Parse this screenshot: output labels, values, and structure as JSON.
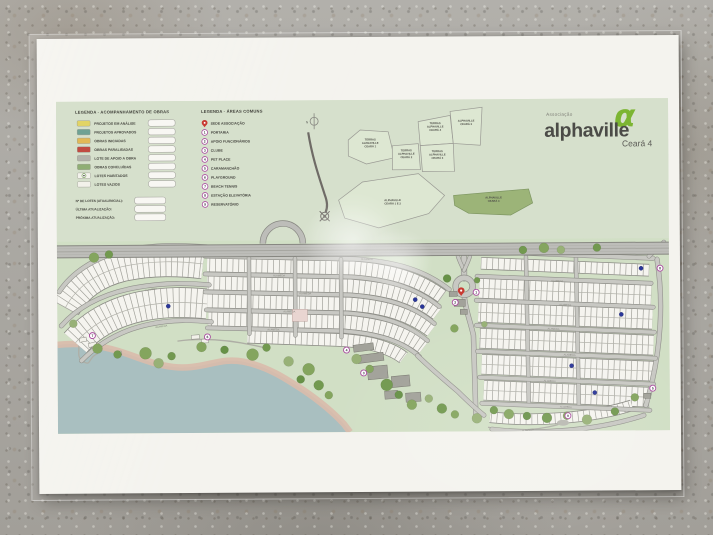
{
  "brand": {
    "association": "Associação",
    "name": "alphaville",
    "phase": "Ceará 4",
    "logo_glyph": "α",
    "logo_green": "#7cb532"
  },
  "legend_obras": {
    "title": "LEGENDA - ACOMPANHAMENTO DE OBRAS",
    "items": [
      {
        "label": "PROJETOS EM ANÁLISE",
        "color": "#e2d465",
        "type": "swatch"
      },
      {
        "label": "PROJETOS APROVADOS",
        "color": "#6fa294",
        "type": "swatch"
      },
      {
        "label": "OBRAS INICIADAS",
        "color": "#e2b957",
        "type": "swatch"
      },
      {
        "label": "OBRAS PARALISADAS",
        "color": "#c14b42",
        "type": "swatch"
      },
      {
        "label": "LOTE DE APOIO A OBRA",
        "color": "#b3b3ab",
        "type": "swatch"
      },
      {
        "label": "OBRAS CONCLUÍDAS",
        "color": "#8fae74",
        "type": "swatch"
      },
      {
        "label": "LOTES HABITADOS",
        "color": "#f3f2ec",
        "type": "dot"
      },
      {
        "label": "LOTES VAZIOS",
        "color": "#f2f1ea",
        "type": "swatch"
      }
    ],
    "fields": [
      "Nº DE LOTES (ATUAL/INICIAL):",
      "ÚLTIMA ATUALIZAÇÃO:",
      "PRÓXIMA ATUALIZAÇÃO:"
    ]
  },
  "legend_areas": {
    "title": "LEGENDA - ÁREAS COMUNS",
    "items": [
      {
        "marker": "pin",
        "label": "SEDE ASSOCIAÇÃO"
      },
      {
        "marker": "1",
        "label": "PORTARIA"
      },
      {
        "marker": "2",
        "label": "APOIO FUNCIONÁRIOS"
      },
      {
        "marker": "3",
        "label": "CLUBE"
      },
      {
        "marker": "4",
        "label": "PET PLACE"
      },
      {
        "marker": "5",
        "label": "CARAMANCHÃO"
      },
      {
        "marker": "6",
        "label": "PLAYGROUND"
      },
      {
        "marker": "7",
        "label": "BEACH TENNIS"
      },
      {
        "marker": "8",
        "label": "ESTAÇÃO ELEVATÓRIA"
      },
      {
        "marker": "9",
        "label": "RESERVATÓRIO"
      }
    ]
  },
  "inset": {
    "north_label": "N",
    "areas": [
      {
        "lines": [
          "TERRAS",
          "ALPHAVILLE",
          "CEARÁ 1"
        ],
        "points": "292,40 304,30 332,32 338,58 310,64 292,56",
        "cx": 314,
        "cy": 44,
        "highlight": false
      },
      {
        "lines": [
          "TERRAS",
          "ALPHAVILLE",
          "CEARÁ 2"
        ],
        "points": "336,46 362,44 364,70 336,70",
        "cx": 350,
        "cy": 55,
        "highlight": false
      },
      {
        "lines": [
          "TERRAS",
          "ALPHAVILLE",
          "CEARÁ 4"
        ],
        "points": "362,22 394,16 397,44 364,46",
        "cx": 379,
        "cy": 28,
        "highlight": false
      },
      {
        "lines": [
          "ALPHAVILLE",
          "CEARÁ 3"
        ],
        "points": "394,12 426,8 424,46 397,44",
        "cx": 410,
        "cy": 24,
        "highlight": false
      },
      {
        "lines": [
          "TERRAS",
          "ALPHAVILLE",
          "CEARÁ 3"
        ],
        "points": "364,46 397,44 398,72 366,72",
        "cx": 381,
        "cy": 56,
        "highlight": false
      },
      {
        "lines": [
          "ALPHAVILLE",
          "CEARÁ 4"
        ],
        "points": "397,96 472,90 476,104 454,116 412,114 398,106",
        "cx": 437,
        "cy": 101,
        "highlight": true
      },
      {
        "lines": [
          "ALPHAVILLE",
          "CEARÁ 1 E 2"
        ],
        "points": "282,100 306,82 362,74 388,96 372,114 322,128 288,118",
        "cx": 336,
        "cy": 103,
        "highlight": false
      }
    ]
  },
  "map": {
    "street_label": "ALAMEDA",
    "colors": {
      "lot_fill": "#f5f4ef",
      "lot_edge": "#8b8b85",
      "lot_div": "#a2a29b",
      "street": "#c8c8c3",
      "street_edge": "#90908a",
      "highway": "#bdbdb9",
      "highway_edge": "#878781",
      "water": "#a9bfc0",
      "beach": "#d9bcab",
      "marker_ring": "#a84a9e",
      "pin_red": "#c83a32",
      "dot_blue": "#2a3699",
      "paralisada": "#e9d5d1"
    },
    "lake_shore": "M 0 243 C 28 240, 52 246, 74 254 C 98 263, 114 268, 134 266 C 154 264, 166 257, 186 261 C 210 266, 228 278, 246 290 C 262 301, 276 313, 286 324 L 292 332",
    "strips": [
      {
        "d": "M 8 206 C 18 188, 36 172, 66 165 C 96 159, 122 160, 146 163",
        "w": 29,
        "double": true
      },
      {
        "d": "M 18 241 C 32 225, 54 211, 84 205 C 110 200, 130 201, 150 203",
        "w": 29,
        "double": true
      },
      {
        "d": "M 150 164 L 296 168 C 336 171, 362 180, 385 197",
        "w": 13,
        "double": false
      },
      {
        "d": "M 150 182 L 294 186 C 332 189, 358 197, 380 214",
        "w": 13,
        "double": false
      },
      {
        "d": "M 150 200 L 292 204 C 329 207, 353 215, 374 231",
        "w": 13,
        "double": false
      },
      {
        "d": "M 151 218 L 288 222 C 324 225, 347 233, 366 248",
        "w": 13,
        "double": false
      },
      {
        "d": "M 190 236 L 286 240 C 314 242, 333 248, 346 258",
        "w": 12,
        "double": false
      },
      {
        "d": "M 424 164 L 592 172",
        "w": 11,
        "double": false
      },
      {
        "d": "M 422 189 L 594 197",
        "w": 19,
        "double": true
      },
      {
        "d": "M 421 213 L 595 221",
        "w": 19,
        "double": true
      },
      {
        "d": "M 422 239 L 596 247",
        "w": 19,
        "double": true
      },
      {
        "d": "M 424 265 L 596 273",
        "w": 19,
        "double": true
      },
      {
        "d": "M 426 291 L 592 299",
        "w": 19,
        "double": true
      },
      {
        "d": "M 432 318 C 476 323, 532 320, 574 307",
        "w": 10,
        "double": false
      }
    ],
    "streets": [
      {
        "d": "M 2 190 C 14 172, 36 156, 68 149 C 98 143, 124 144, 150 146",
        "w": 3.8
      },
      {
        "d": "M 4 224 C 20 206, 44 192, 80 186 C 110 181, 132 182, 152 184",
        "w": 3.8
      },
      {
        "d": "M 24 259 C 40 243, 62 229, 92 223 C 116 218, 136 219, 154 221",
        "w": 3.8
      },
      {
        "d": "M 148 155 L 298 159 C 340 162, 368 171, 392 190",
        "w": 3.8
      },
      {
        "d": "M 148 173 L 295 177 C 334 180, 360 189, 382 207",
        "w": 3.5
      },
      {
        "d": "M 148 191 L 293 195 C 330 198, 356 206, 377 224",
        "w": 3.5
      },
      {
        "d": "M 149 209 L 290 213 C 326 216, 350 224, 370 241",
        "w": 3.5
      },
      {
        "d": "M 150 227 L 287 231 C 321 234, 344 241, 362 257",
        "w": 3.5
      },
      {
        "d": "M 192 157 L 192 233",
        "w": 3.2
      },
      {
        "d": "M 238 158 L 238 235",
        "w": 3.2
      },
      {
        "d": "M 284 159 L 284 237",
        "w": 3.2
      },
      {
        "d": "M 407 158 L 407 179",
        "w": 5
      },
      {
        "d": "M 407 196 C 408 210, 413 222, 416 236 L 418 318",
        "w": 4.2
      },
      {
        "d": "M 469 158 L 471 306",
        "w": 3.2
      },
      {
        "d": "M 519 159 L 521 308",
        "w": 3.2
      },
      {
        "d": "M 600 161 C 606 200, 605 252, 588 307",
        "w": 4
      },
      {
        "d": "M 420 152 L 596 160",
        "w": 3.8
      },
      {
        "d": "M 420 177 L 594 185",
        "w": 3.5
      },
      {
        "d": "M 419 201 L 596 209",
        "w": 3.5
      },
      {
        "d": "M 419 226 L 597 234",
        "w": 3.5
      },
      {
        "d": "M 420 252 L 598 260",
        "w": 3.5
      },
      {
        "d": "M 422 278 L 596 286",
        "w": 3.5
      },
      {
        "d": "M 424 304 L 592 312",
        "w": 3.5
      },
      {
        "d": "M 434 330 C 480 336, 540 332, 586 317",
        "w": 3.8
      },
      {
        "d": "M 360 256 C 372 268, 386 280, 400 292 C 408 300, 416 308, 426 316",
        "w": 3.8
      },
      {
        "d": "M 401 157 C 403 163, 405 167, 407 171",
        "w": 3
      },
      {
        "d": "M 413 157 C 411 163, 409 167, 407 171",
        "w": 3
      },
      {
        "d": "M 592 158 C 599 151, 603 148, 607 144",
        "w": 3.5
      }
    ],
    "trails": [
      "M 18 234 C 26 246, 16 254, 26 260 C 34 265, 30 256, 40 252",
      "M 120 240 C 150 236, 180 240, 210 248",
      "M 430 328 C 460 334, 488 330, 506 324 C 530 316, 520 318, 545 315 C 560 313, 572 310, 584 305"
    ],
    "highway": {
      "y": 150,
      "half": 6,
      "loop_cx": 226,
      "loop_r": 20,
      "roundabout": {
        "x": 407,
        "y": 187,
        "r": 8.5
      }
    },
    "trees": [
      [
        37,
        156,
        5,
        0
      ],
      [
        52,
        153,
        4,
        1
      ],
      [
        16,
        222,
        4,
        2
      ],
      [
        40,
        247,
        5,
        0
      ],
      [
        60,
        253,
        4,
        1
      ],
      [
        88,
        252,
        6,
        0
      ],
      [
        101,
        262,
        5,
        2
      ],
      [
        114,
        255,
        4,
        1
      ],
      [
        144,
        246,
        5,
        0
      ],
      [
        167,
        249,
        4,
        3
      ],
      [
        195,
        254,
        6,
        0
      ],
      [
        209,
        247,
        4,
        1
      ],
      [
        231,
        261,
        5,
        2
      ],
      [
        251,
        269,
        6,
        0
      ],
      [
        243,
        279,
        4,
        3
      ],
      [
        261,
        285,
        5,
        1
      ],
      [
        271,
        295,
        4,
        0
      ],
      [
        299,
        259,
        5,
        2
      ],
      [
        312,
        269,
        4,
        0
      ],
      [
        329,
        285,
        6,
        1
      ],
      [
        341,
        295,
        4,
        3
      ],
      [
        354,
        305,
        5,
        0
      ],
      [
        371,
        299,
        4,
        2
      ],
      [
        384,
        309,
        5,
        1
      ],
      [
        397,
        315,
        4,
        0
      ],
      [
        419,
        319,
        5,
        2
      ],
      [
        436,
        311,
        4,
        1
      ],
      [
        451,
        315,
        5,
        0
      ],
      [
        469,
        317,
        4,
        3
      ],
      [
        489,
        319,
        5,
        1
      ],
      [
        509,
        317,
        4,
        0
      ],
      [
        529,
        321,
        5,
        2
      ],
      [
        557,
        313,
        4,
        1
      ],
      [
        577,
        299,
        4,
        0
      ],
      [
        390,
        179,
        4,
        3
      ],
      [
        420,
        181,
        3,
        1
      ],
      [
        397,
        229,
        4,
        0
      ],
      [
        427,
        225,
        3,
        2
      ],
      [
        466,
        151,
        4,
        1
      ],
      [
        487,
        149,
        5,
        0
      ],
      [
        504,
        151,
        4,
        2
      ],
      [
        540,
        149,
        4,
        1
      ]
    ],
    "tree_colors": [
      "#84a55e",
      "#72994f",
      "#98b177",
      "#679147"
    ],
    "buildings": [
      [
        296,
        244,
        20,
        7,
        -7,
        "g"
      ],
      [
        300,
        254,
        26,
        8,
        -7,
        "g"
      ],
      [
        310,
        266,
        20,
        13,
        -5,
        "g"
      ],
      [
        334,
        276,
        18,
        11,
        -5,
        "g"
      ],
      [
        327,
        291,
        13,
        8,
        -4,
        "g"
      ],
      [
        348,
        293,
        15,
        9,
        -4,
        "g"
      ],
      [
        392,
        192,
        8,
        5,
        0,
        "g"
      ],
      [
        397,
        200,
        11,
        7,
        0,
        "g"
      ],
      [
        403,
        210,
        7,
        5,
        0,
        "g"
      ],
      [
        22,
        236,
        7,
        4,
        -10,
        "w"
      ],
      [
        31,
        241,
        8,
        4,
        -14,
        "w"
      ],
      [
        134,
        234,
        8,
        4,
        -4,
        "w"
      ],
      [
        144,
        238,
        7,
        4,
        -4,
        "w"
      ],
      [
        58,
        250,
        6,
        4,
        -10,
        "w"
      ],
      [
        586,
        295,
        7,
        5,
        0,
        "g"
      ]
    ],
    "plaza": {
      "x": 505,
      "y": 324,
      "rx": 6,
      "ry": 3
    },
    "markers": [
      {
        "n": "1",
        "x": 419,
        "y": 193
      },
      {
        "n": "2",
        "x": 398,
        "y": 203
      },
      {
        "n": "3",
        "x": 306,
        "y": 273
      },
      {
        "n": "4",
        "x": 289,
        "y": 250
      },
      {
        "n": "5",
        "x": 595,
        "y": 290
      },
      {
        "n": "6",
        "x": 150,
        "y": 236
      },
      {
        "n": "7",
        "x": 35,
        "y": 234
      },
      {
        "n": "8",
        "x": 603,
        "y": 170
      },
      {
        "n": "9",
        "x": 510,
        "y": 317
      }
    ],
    "sede_pin": {
      "x": 404,
      "y": 192
    },
    "occupied_dots": [
      [
        111,
        205
      ],
      [
        358,
        200
      ],
      [
        365,
        207
      ],
      [
        584,
        170
      ],
      [
        564,
        216
      ],
      [
        514,
        267
      ],
      [
        537,
        294
      ]
    ],
    "paralyzed_block": {
      "x": 235,
      "y": 209,
      "w": 15,
      "h": 12
    },
    "street_labels": [
      [
        222,
        176,
        1
      ],
      [
        248,
        194,
        1
      ],
      [
        232,
        212,
        1
      ],
      [
        216,
        230,
        1
      ],
      [
        500,
        183,
        3
      ],
      [
        508,
        207,
        3
      ],
      [
        496,
        231,
        3
      ],
      [
        512,
        257,
        3
      ],
      [
        492,
        283,
        3
      ],
      [
        508,
        309,
        3
      ],
      [
        470,
        332,
        -8
      ],
      [
        94,
        189,
        -9
      ],
      [
        104,
        226,
        -7
      ],
      [
        310,
        160,
        1
      ]
    ]
  }
}
